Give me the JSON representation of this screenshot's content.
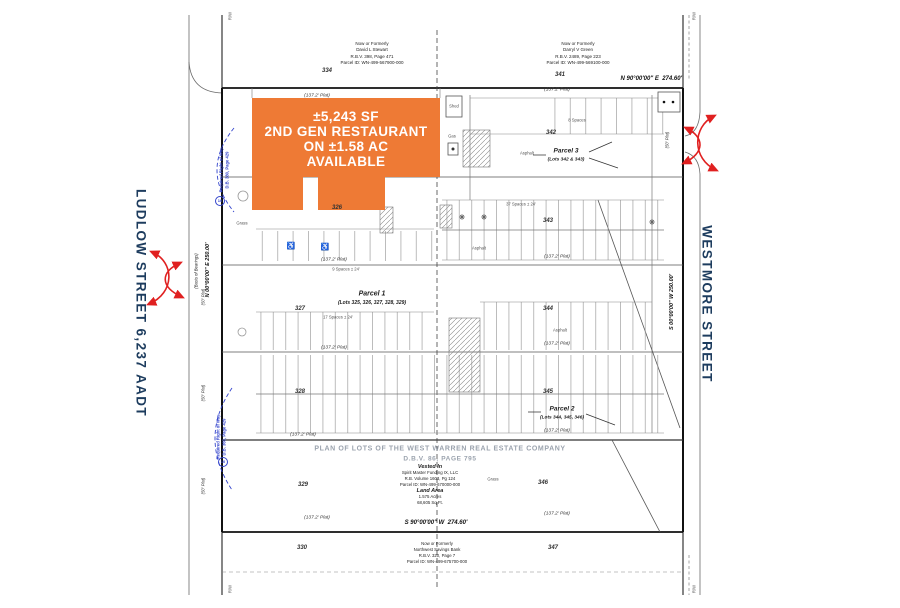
{
  "colors": {
    "orange": "#EE7A35",
    "navy": "#1D3C5E",
    "red": "#E02020",
    "blue": "#3344CC"
  },
  "streets": {
    "left": "LUDLOW STREET 6,237 AADT",
    "right": "WESTMORE STREET"
  },
  "highlight": {
    "line1": "±5,243 SF",
    "line2": "2ND GEN RESTAURANT",
    "line3": "ON ±1.58 AC",
    "line4": "AVAILABLE"
  },
  "owners": {
    "top_left": {
      "l1": "Now or Formerly",
      "l2": "David L Stewart",
      "l3": "R.B.V. 398, Page 471",
      "l4": "Parcel ID: WN-499-567900-000"
    },
    "top_right": {
      "l1": "Now or Formerly",
      "l2": "Darryl V Green",
      "l3": "R.B.V. 2489, Page 223",
      "l4": "Parcel ID: WN-499-569100-000"
    },
    "bottom": {
      "l1": "Now or Formerly",
      "l2": "Northwest Savings Bank",
      "l3": "R.B.V. 320, Page 7",
      "l4": "Parcel ID: WN-499-675700-000"
    }
  },
  "parcels": {
    "p1": {
      "name": "Parcel 1",
      "lots": "(Lots 325, 326, 327, 328, 329)"
    },
    "p2": {
      "name": "Parcel 2",
      "lots": "(Lots 344, 345, 346)"
    },
    "p3": {
      "name": "Parcel 3",
      "lots": "(Lots 342 & 343)"
    }
  },
  "lots": {
    "tl": "334",
    "tr": "341",
    "l1": "326",
    "l2": "327",
    "l3": "328",
    "l4": "329",
    "l5": "330",
    "r1": "342",
    "r2": "343",
    "r3": "344",
    "r4": "345",
    "r5": "346",
    "r6": "347"
  },
  "bearings": {
    "north": "N 90°00'00\" E",
    "north_dist": "274.60'",
    "south": "S 90°00'00\" W",
    "south_dist": "274.60'",
    "west": "N 00°00'00\" E   250.00'",
    "west_note": "(Basis of Bearings)",
    "east": "S 00°00'00\" W   250.00'"
  },
  "plat_notes": {
    "p137": "(137.2' Plat)",
    "p50": "(50' Plat)",
    "rw": "R/W"
  },
  "title": {
    "line1": "PLAN OF LOTS OF THE WEST WARREN REAL ESTATE COMPANY",
    "line2": "D.B.V. 86, PAGE 795"
  },
  "vested": {
    "h": "Vested In",
    "l1": "Spirit Master Funding IX, LLC",
    "l2": "R.B. Volume 1603, Pg 124",
    "l3": "Parcel ID: WN-499-670000-000"
  },
  "land": {
    "h": "Land Area",
    "l1": "1.575 Acres",
    "l2": "68,605 Sq.Ft."
  },
  "site": {
    "shed": "Shed",
    "gas": "Gas",
    "asphalt": "Asphalt",
    "grass": "Grass",
    "spaces8": "8 Spaces",
    "spaces37": "37 Spaces ± 24'",
    "spaces9": "9 Spaces ± 24'",
    "spaces17": "17 Spaces ± 24'"
  },
  "row_notes": {
    "req1": "Required Right of Way",
    "req1b": "D.B. 380, Page 429",
    "req2": "Required Right of Way",
    "req2b": "D.B. 360, Page 429",
    "badge": "10"
  },
  "icons": {
    "handicap": "♿"
  }
}
